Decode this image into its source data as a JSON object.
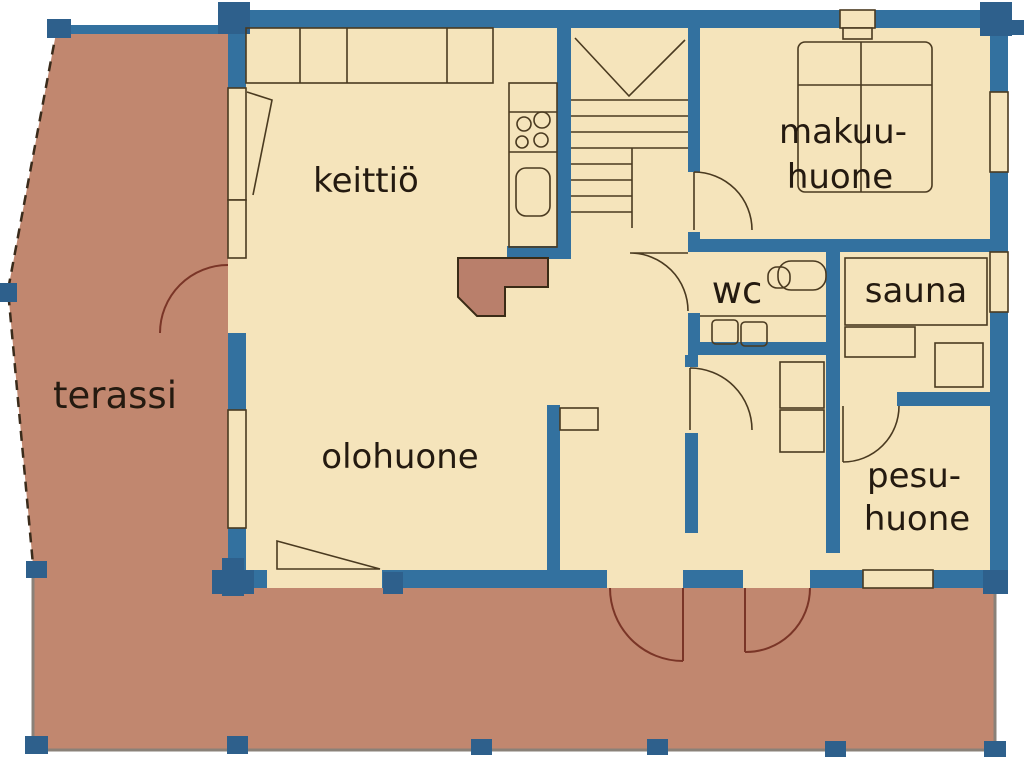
{
  "plan_title": "floor plan",
  "rooms": {
    "terassi": {
      "label": "terassi"
    },
    "keittio": {
      "label": "keittiö"
    },
    "olohuone": {
      "label": "olohuone"
    },
    "makuuhuone": {
      "label_line1": "makuu-",
      "label_line2": "huone"
    },
    "wc": {
      "label": "wc"
    },
    "sauna": {
      "label": "sauna"
    },
    "pesuhuone": {
      "label_line1": "pesu-",
      "label_line2": "huone"
    }
  },
  "colors": {
    "wall_blue": "#33719f",
    "post_blue": "#2e608c",
    "floor_cream": "#f5e4bb",
    "terrace_salmon": "#c1876f",
    "fireplace_red": "#b97f6b",
    "outline_dark": "#4a3a20",
    "terrace_door_arc": "#7a3527",
    "label_text": "#241a10",
    "background": "#ffffff"
  }
}
